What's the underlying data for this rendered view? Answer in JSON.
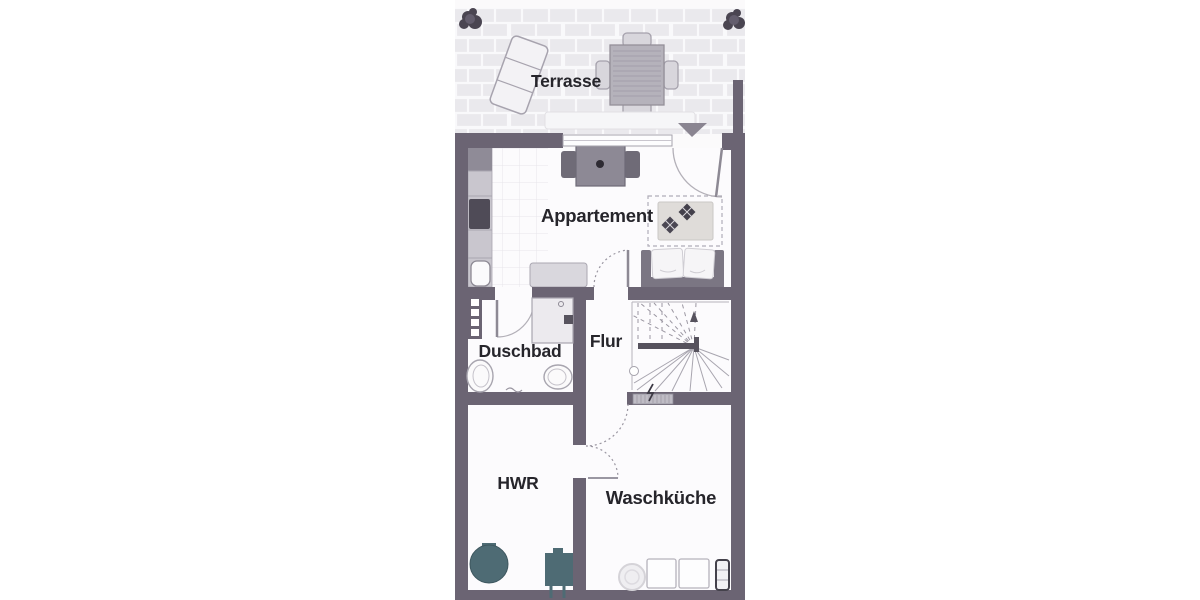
{
  "floorplan": {
    "labels": {
      "terrasse": "Terrasse",
      "appartement": "Appartement",
      "duschbad": "Duschbad",
      "flur": "Flur",
      "hwr": "HWR",
      "waschkueche": "Waschküche"
    },
    "colors": {
      "wall": "#6b6473",
      "equipment_teal": "#4e6b74",
      "label_text": "#26252b",
      "paving_tile": "#eae9ed",
      "furniture_gray": "#8d8995"
    },
    "symbols": [
      "plant",
      "sun-lounger",
      "patio-dining-set",
      "direction-triangle",
      "sliding-window",
      "entry-door-arc",
      "dining-table",
      "kitchenette",
      "sideboard",
      "rug",
      "cushion",
      "sofa",
      "shower",
      "washbasin",
      "toilet",
      "winder-stairs",
      "handrail",
      "electrical-panel",
      "water-tank",
      "heating-unit",
      "floor-drain",
      "washing-machine",
      "dryer",
      "radiator"
    ]
  }
}
